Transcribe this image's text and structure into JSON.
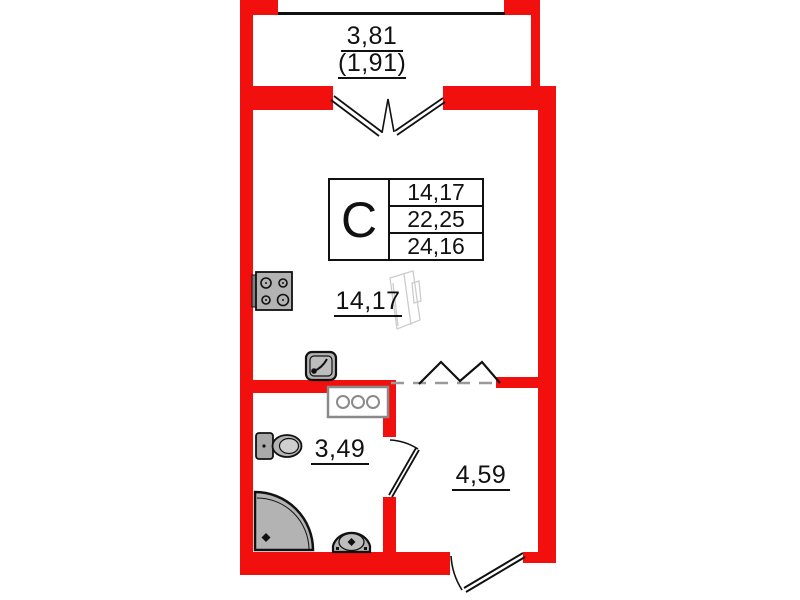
{
  "plan_type": "studio-apartment-floor-plan",
  "unit_table": {
    "letter": "С",
    "values": [
      "14,17",
      "22,25",
      "24,16"
    ]
  },
  "balcony": {
    "width_label": "3,81",
    "half_width_label": "(1,91)"
  },
  "rooms": [
    {
      "id": "living-kitchen",
      "area_label": "14,17"
    },
    {
      "id": "bathroom",
      "area_label": "3,49"
    },
    {
      "id": "hallway",
      "area_label": "4,59"
    }
  ],
  "icons": [
    "stove-icon",
    "kitchen-sink-icon",
    "washing-machine-icon",
    "toilet-icon",
    "shower-icon",
    "washbasin-icon",
    "balcony-double-door-icon",
    "bathroom-door-icon",
    "entrance-door-icon",
    "wardrobe-zigzag-icon"
  ],
  "colors": {
    "wall": "#f2100e",
    "line": "#111111",
    "fixture_fill": "#b3b3b3",
    "dashed_line": "#9a9a9a",
    "watermark": "#cccccc",
    "background": "#ffffff"
  }
}
